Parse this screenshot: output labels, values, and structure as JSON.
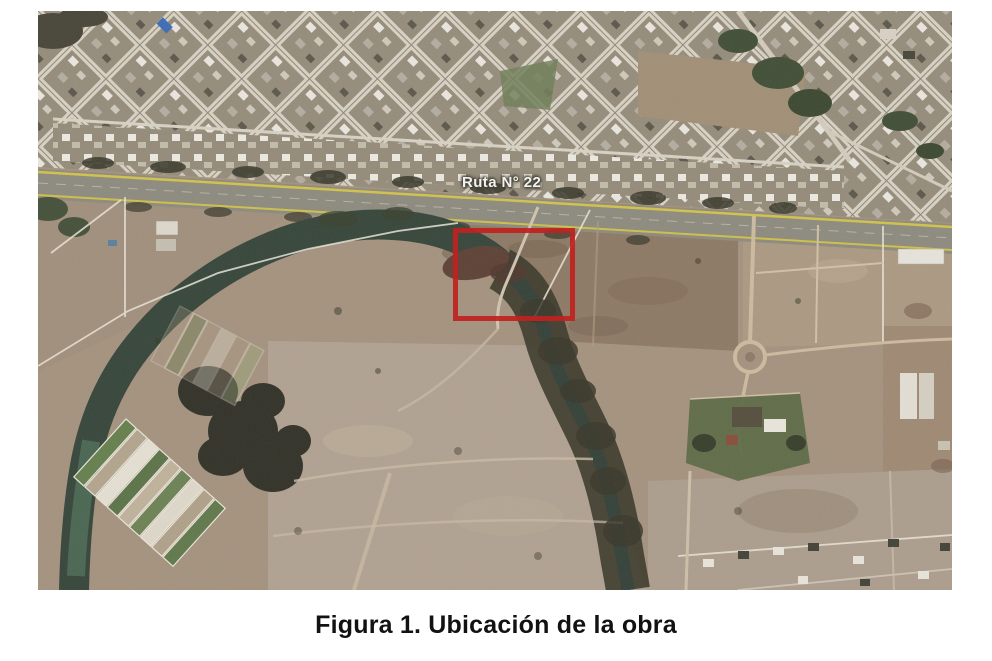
{
  "page": {
    "background_color": "#ffffff"
  },
  "figure": {
    "caption": "Figura 1. Ubicación de la obra",
    "map": {
      "type": "satellite-aerial-photo",
      "road_label": "Ruta N° 22",
      "colors": {
        "highlight": "#c0221f",
        "land": "#a5937f",
        "urban": "#8f8777",
        "street": "#d8d2c4",
        "highway": "#8e8b7f",
        "highway-line": "#d2c24d",
        "river": "#38473c",
        "trees": "#3a392b",
        "field": "#b1a292",
        "parcel-line": "#eae4d8"
      }
    }
  }
}
